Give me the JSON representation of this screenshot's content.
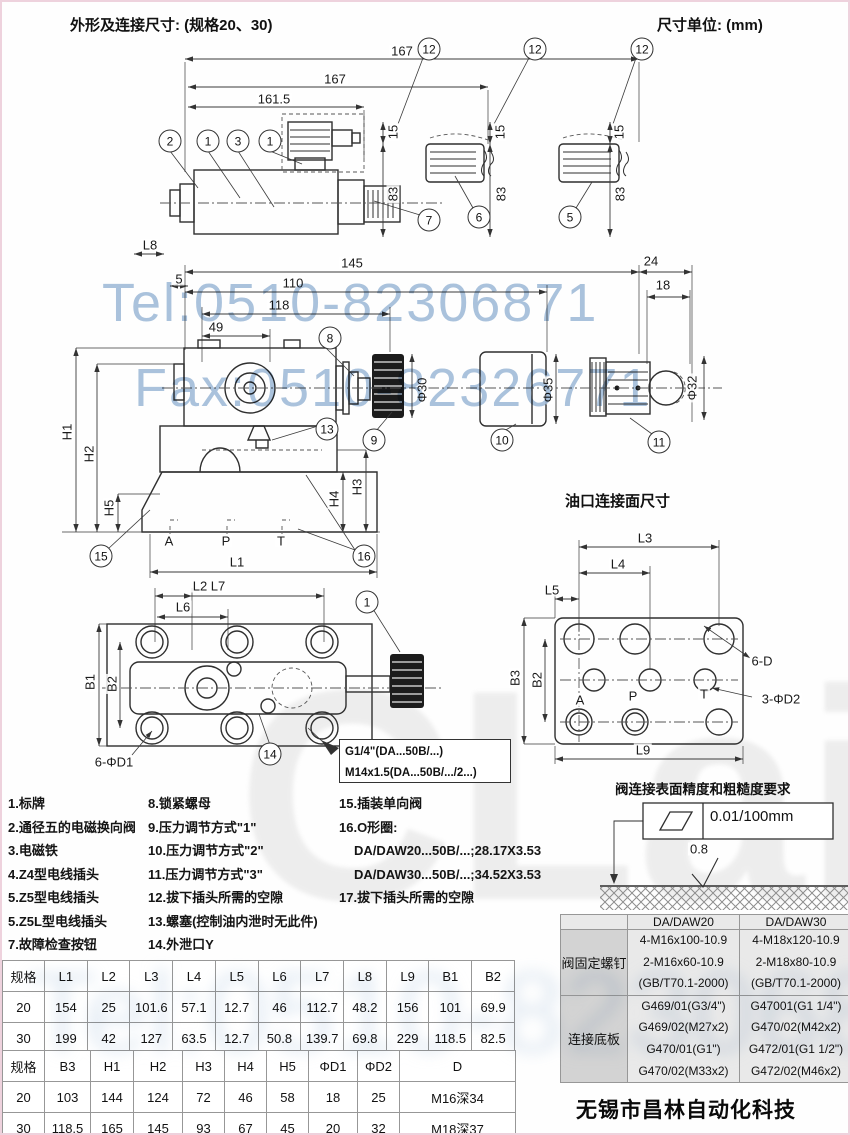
{
  "page": {
    "title_left": "外形及连接尺寸: (规格20、30)",
    "title_right": "尺寸单位: (mm)"
  },
  "watermarks": {
    "tel": "Tel:0510-82306871",
    "fax": "Fax:0510-82326771",
    "brand": "CLair",
    "company": "无锡市昌林自动化科技",
    "blue": "#9cb9d7",
    "gray": "#bdbdbd"
  },
  "drawing": {
    "section_title": "油口连接面尺寸",
    "surface_title": "阀连接表面精度和粗糙度要求",
    "flatness": "0.01/100mm",
    "note_box": [
      "G1/4\"(DA...50B/...)",
      "M14x1.5(DA...50B/.../2...)"
    ],
    "dim_labels": [
      {
        "t": "167",
        "x": 400,
        "y": 49
      },
      {
        "t": "167",
        "x": 333,
        "y": 77
      },
      {
        "t": "161.5",
        "x": 272,
        "y": 97
      },
      {
        "t": "15",
        "x": 391,
        "y": 130,
        "r": 1
      },
      {
        "t": "15",
        "x": 498,
        "y": 130,
        "r": 1
      },
      {
        "t": "15",
        "x": 617,
        "y": 130,
        "r": 1
      },
      {
        "t": "83",
        "x": 391,
        "y": 192,
        "r": 1
      },
      {
        "t": "83",
        "x": 499,
        "y": 192,
        "r": 1
      },
      {
        "t": "83",
        "x": 618,
        "y": 192,
        "r": 1
      },
      {
        "t": "L8",
        "x": 148,
        "y": 243
      },
      {
        "t": "5",
        "x": 177,
        "y": 277
      },
      {
        "t": "145",
        "x": 350,
        "y": 261
      },
      {
        "t": "24",
        "x": 649,
        "y": 259
      },
      {
        "t": "18",
        "x": 661,
        "y": 283
      },
      {
        "t": "110",
        "x": 291,
        "y": 281
      },
      {
        "t": "118",
        "x": 277,
        "y": 303
      },
      {
        "t": "49",
        "x": 214,
        "y": 325
      },
      {
        "t": "Φ30",
        "x": 420,
        "y": 388,
        "r": 1
      },
      {
        "t": "Φ35",
        "x": 546,
        "y": 388,
        "r": 1
      },
      {
        "t": "Φ32",
        "x": 690,
        "y": 386,
        "r": 1
      },
      {
        "t": "H1",
        "x": 65,
        "y": 430,
        "r": 1
      },
      {
        "t": "H2",
        "x": 87,
        "y": 452,
        "r": 1
      },
      {
        "t": "H5",
        "x": 107,
        "y": 506,
        "r": 1
      },
      {
        "t": "H4",
        "x": 332,
        "y": 497,
        "r": 1
      },
      {
        "t": "H3",
        "x": 355,
        "y": 485,
        "r": 1
      },
      {
        "t": "A",
        "x": 167,
        "y": 539
      },
      {
        "t": "P",
        "x": 224,
        "y": 539
      },
      {
        "t": "T",
        "x": 279,
        "y": 539
      },
      {
        "t": "L1",
        "x": 235,
        "y": 560
      },
      {
        "t": "L2 L7",
        "x": 207,
        "y": 584
      },
      {
        "t": "L6",
        "x": 181,
        "y": 605
      },
      {
        "t": "B1",
        "x": 88,
        "y": 680,
        "r": 1
      },
      {
        "t": "B2",
        "x": 110,
        "y": 682,
        "r": 1
      },
      {
        "t": "6-ΦD1",
        "x": 112,
        "y": 760
      },
      {
        "t": "L3",
        "x": 643,
        "y": 536
      },
      {
        "t": "L4",
        "x": 616,
        "y": 562
      },
      {
        "t": "L5",
        "x": 550,
        "y": 588
      },
      {
        "t": "B3",
        "x": 513,
        "y": 676,
        "r": 1
      },
      {
        "t": "B2",
        "x": 535,
        "y": 678,
        "r": 1
      },
      {
        "t": "L9",
        "x": 641,
        "y": 748
      },
      {
        "t": "6-D",
        "x": 760,
        "y": 659
      },
      {
        "t": "3-ΦD2",
        "x": 779,
        "y": 697
      },
      {
        "t": "A",
        "x": 578,
        "y": 698
      },
      {
        "t": "P",
        "x": 631,
        "y": 694
      },
      {
        "t": "T",
        "x": 702,
        "y": 692
      },
      {
        "t": "0.8",
        "x": 697,
        "y": 847
      }
    ],
    "callouts": [
      {
        "n": "12",
        "x": 427,
        "y": 47
      },
      {
        "n": "12",
        "x": 533,
        "y": 47
      },
      {
        "n": "12",
        "x": 640,
        "y": 47
      },
      {
        "n": "2",
        "x": 168,
        "y": 139
      },
      {
        "n": "1",
        "x": 206,
        "y": 139
      },
      {
        "n": "3",
        "x": 236,
        "y": 139
      },
      {
        "n": "1",
        "x": 268,
        "y": 139
      },
      {
        "n": "7",
        "x": 427,
        "y": 218
      },
      {
        "n": "6",
        "x": 477,
        "y": 215
      },
      {
        "n": "5",
        "x": 568,
        "y": 215
      },
      {
        "n": "8",
        "x": 328,
        "y": 336
      },
      {
        "n": "13",
        "x": 325,
        "y": 427
      },
      {
        "n": "9",
        "x": 372,
        "y": 438
      },
      {
        "n": "10",
        "x": 500,
        "y": 438
      },
      {
        "n": "11",
        "x": 657,
        "y": 440
      },
      {
        "n": "15",
        "x": 99,
        "y": 554
      },
      {
        "n": "16",
        "x": 362,
        "y": 554
      },
      {
        "n": "1",
        "x": 365,
        "y": 600
      },
      {
        "n": "14",
        "x": 268,
        "y": 752
      }
    ]
  },
  "legend": {
    "col1": [
      "1.标牌",
      "2.通径五的电磁换向阀",
      "3.电磁铁",
      "4.Z4型电线插头",
      "5.Z5型电线插头",
      "5.Z5L型电线插头",
      "7.故障检查按钮"
    ],
    "col2": [
      "8.锁紧螺母",
      "9.压力调节方式\"1\"",
      "10.压力调节方式\"2\"",
      "11.压力调节方式\"3\"",
      "12.拔下插头所需的空隙",
      "13.螺塞(控制油内泄时无此件)",
      "14.外泄口Y"
    ],
    "col3": [
      "15.插装单向阀",
      "16.O形圈:",
      "DA/DAW20...50B/...;28.17X3.53",
      "DA/DAW30...50B/...;34.52X3.53",
      "17.拔下插头所需的空隙"
    ]
  },
  "dim_table": {
    "header1": [
      "规格",
      "L1",
      "L2",
      "L3",
      "L4",
      "L5",
      "L6",
      "L7",
      "L8",
      "L9",
      "B1",
      "B2"
    ],
    "rows1": [
      [
        "20",
        "154",
        "25",
        "101.6",
        "57.1",
        "12.7",
        "46",
        "112.7",
        "48.2",
        "156",
        "101",
        "69.9"
      ],
      [
        "30",
        "199",
        "42",
        "127",
        "63.5",
        "12.7",
        "50.8",
        "139.7",
        "69.8",
        "229",
        "118.5",
        "82.5"
      ]
    ],
    "header2": [
      "规格",
      "B3",
      "H1",
      "H2",
      "H3",
      "H4",
      "H5",
      "ΦD1",
      "ΦD2",
      "D"
    ],
    "rows2": [
      [
        "20",
        "103",
        "144",
        "124",
        "72",
        "46",
        "58",
        "18",
        "25",
        "M16深34"
      ],
      [
        "30",
        "118.5",
        "165",
        "145",
        "93",
        "67",
        "45",
        "20",
        "32",
        "M18深37"
      ]
    ]
  },
  "spec_table": {
    "corner": "",
    "col_headers": [
      "DA/DAW20",
      "DA/DAW30"
    ],
    "rows": [
      {
        "label": "阀固定螺钉",
        "c1": [
          "4-M16x100-10.9",
          "2-M16x60-10.9",
          "(GB/T70.1-2000)"
        ],
        "c2": [
          "4-M18x120-10.9",
          "2-M18x80-10.9",
          "(GB/T70.1-2000)"
        ]
      },
      {
        "label": "连接底板",
        "c1": [
          "G469/01(G3/4\")",
          "G469/02(M27x2)",
          "G470/01(G1\")",
          "G470/02(M33x2)"
        ],
        "c2": [
          "G47001(G1 1/4\")",
          "G470/02(M42x2)",
          "G472/01(G1 1/2\")",
          "G472/02(M46x2)"
        ]
      }
    ]
  }
}
